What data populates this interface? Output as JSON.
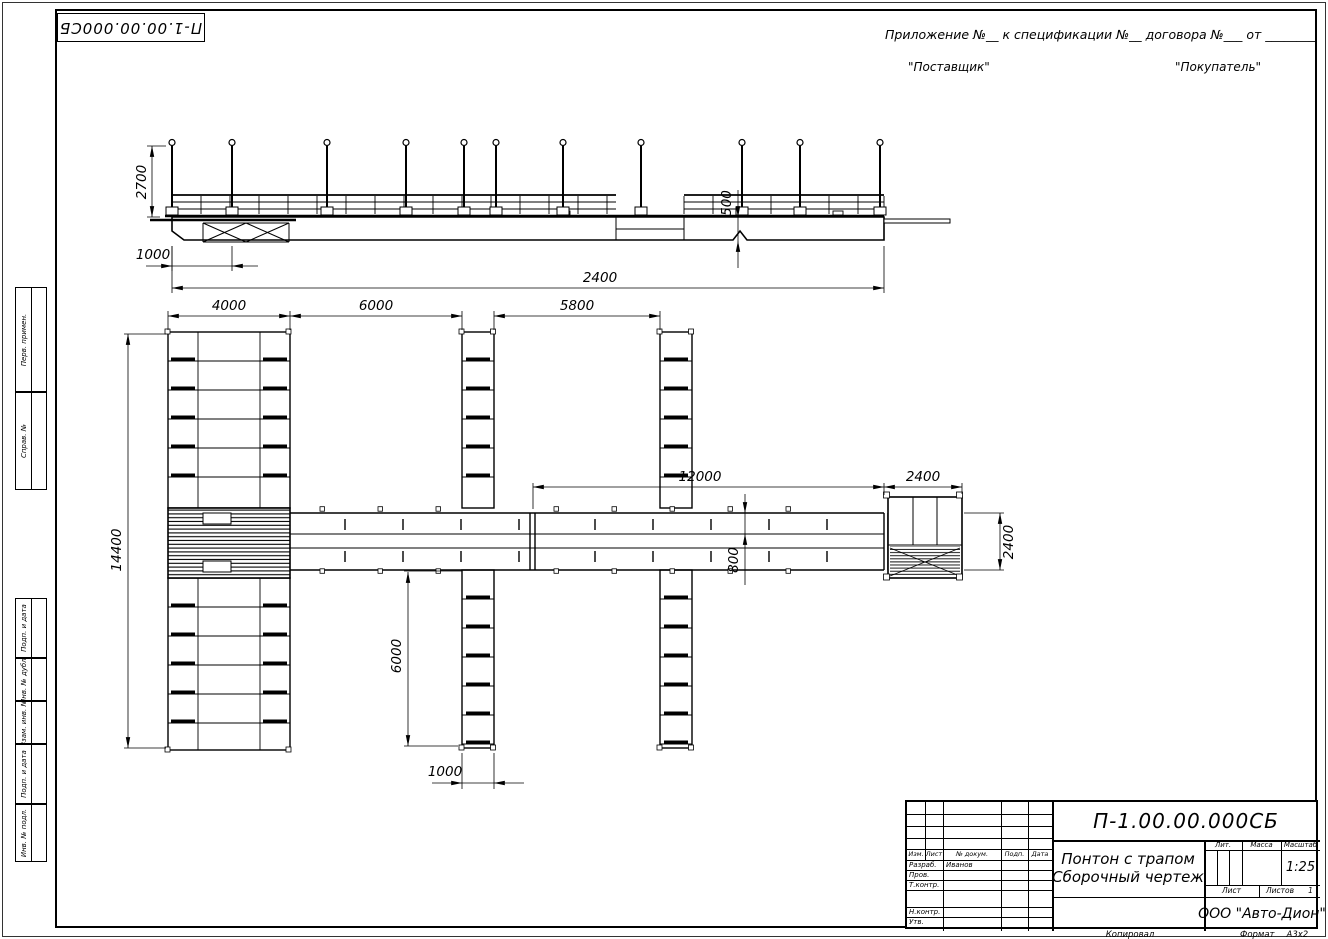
{
  "corner_stamp": "П-1.00.00.000СБ",
  "header": {
    "line1": "Приложение №__      к спецификации №__    договора №___  от ________",
    "supplier": "\"Поставщик\"",
    "buyer": "\"Покупатель\""
  },
  "margin_labels": [
    "Перв. примен.",
    "Справ. №",
    "Подп. и дата",
    "Инв. № дубл.",
    "Взам. инв. №",
    "Подп. и дата",
    "Инв. № подл."
  ],
  "dims": {
    "post_height": "2700",
    "left_offset": "1000",
    "hull_height": "500",
    "overall_length": "2400",
    "pier_width": "4000",
    "bay1": "6000",
    "bay2": "5800",
    "walkway_length": "12000",
    "end_pontoon_width": "2400",
    "pier_length": "14400",
    "finger_length": "6000",
    "finger_width": "1000",
    "walkway_width": "800",
    "end_pontoon_length": "2400"
  },
  "title_block": {
    "doc_number": "П-1.00.00.000СБ",
    "title_line1": "Понтон с трапом",
    "title_line2": "Сборочный чертеж",
    "col_izm": "Изм.",
    "col_list": "Лист",
    "col_dok": "№ докум.",
    "col_podp": "Подп.",
    "col_data": "Дата",
    "row_razrab": "Разраб.",
    "razrab_name": "Иванов",
    "row_prov": "Пров.",
    "row_tkontr": "Т.контр.",
    "row_nkontr": "Н.контр.",
    "row_utv": "Утв.",
    "lit_label": "Лит.",
    "massa_label": "Масса",
    "masshtab_label": "Масштаб",
    "scale_value": "1:25",
    "list_label": "Лист",
    "listov_label": "Листов",
    "listov_value": "1",
    "company": "ООО \"Авто-Дион\""
  },
  "footer": {
    "kopiroval": "Копировал",
    "format_label": "Формат",
    "format_value": "А3х2"
  }
}
